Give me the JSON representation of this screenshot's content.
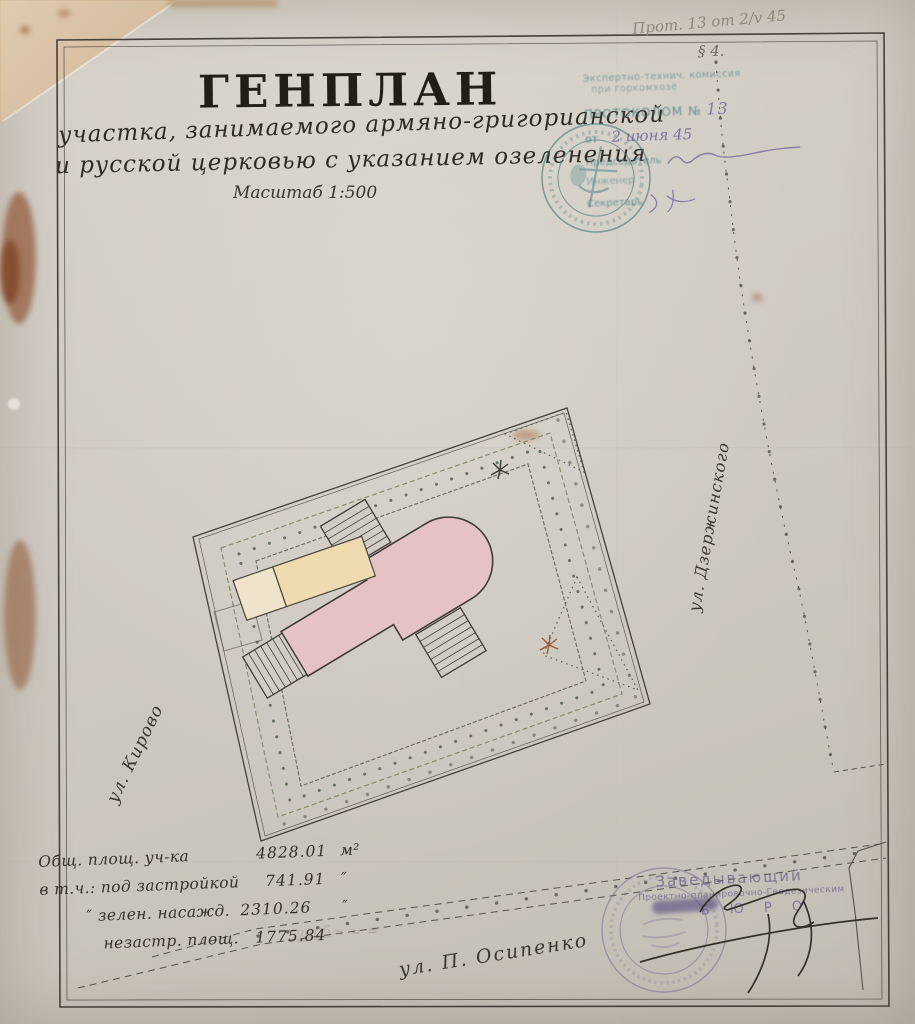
{
  "document": {
    "title": "ГЕНПЛАН",
    "subtitle_line1": "участка, занимаемого армяно-григорианской",
    "subtitle_line2": "и русской церковью с указанием озеленения",
    "scale_note": "Масштаб 1:500"
  },
  "pencil_notes": {
    "top_right": "Прот. 13 от 2/v 45",
    "section_mark": "§ 4.",
    "bottom_faint": "2405"
  },
  "approval_stamp": {
    "line1": "Экспертно-технич. комиссия",
    "line2": "при горкомхозе",
    "protocol_label": "ПРОТОКОЛОМ №",
    "protocol_number": "13",
    "date_prefix": "от",
    "date_value": "2 июня 45",
    "role_chairman": "Председатель",
    "role_engineer": "Инженер",
    "role_secretary": "Секретарь",
    "ink_color": "#3d7c7e",
    "signature_ink_color": "#6b5a9e"
  },
  "plan": {
    "site_name": "участок армяно-григорианской и русской церквей",
    "buildings": [
      {
        "name": "церковь",
        "color": "#e5c3c5"
      },
      {
        "name": "хозпостройка",
        "color": "#eedcb0"
      }
    ],
    "streets": {
      "left": "ул. Кирово",
      "right": "ул. Дзержинского",
      "bottom": "ул. П. Осипенко"
    },
    "greenery_color": "#5f7a52",
    "ink_color": "#45413a"
  },
  "area_table": {
    "rows": [
      {
        "label": "Общ. площ. уч-ка",
        "value": "4828.01",
        "unit": "м²"
      },
      {
        "label": "в т.ч.: под застройкой",
        "value": "741.91",
        "unit": "″"
      },
      {
        "label": "″   зелен. насажд.",
        "value": "2310.26",
        "unit": "″"
      },
      {
        "label": "незастр. площ.",
        "value": "1775.84",
        "unit": ""
      }
    ],
    "pencil_ticks": "≈ ≈ ="
  },
  "bureau_stamp": {
    "line1": "Заведывающий",
    "line2": "Проектно-планировочно-Геодезическим",
    "line3": "Б Ю Р О",
    "ink_color": "#6f6390"
  },
  "colors": {
    "paper": "#d0cbc3",
    "backing": "#b28353",
    "rust_stain": "#8f4f2c",
    "pencil": "#8d8679"
  }
}
